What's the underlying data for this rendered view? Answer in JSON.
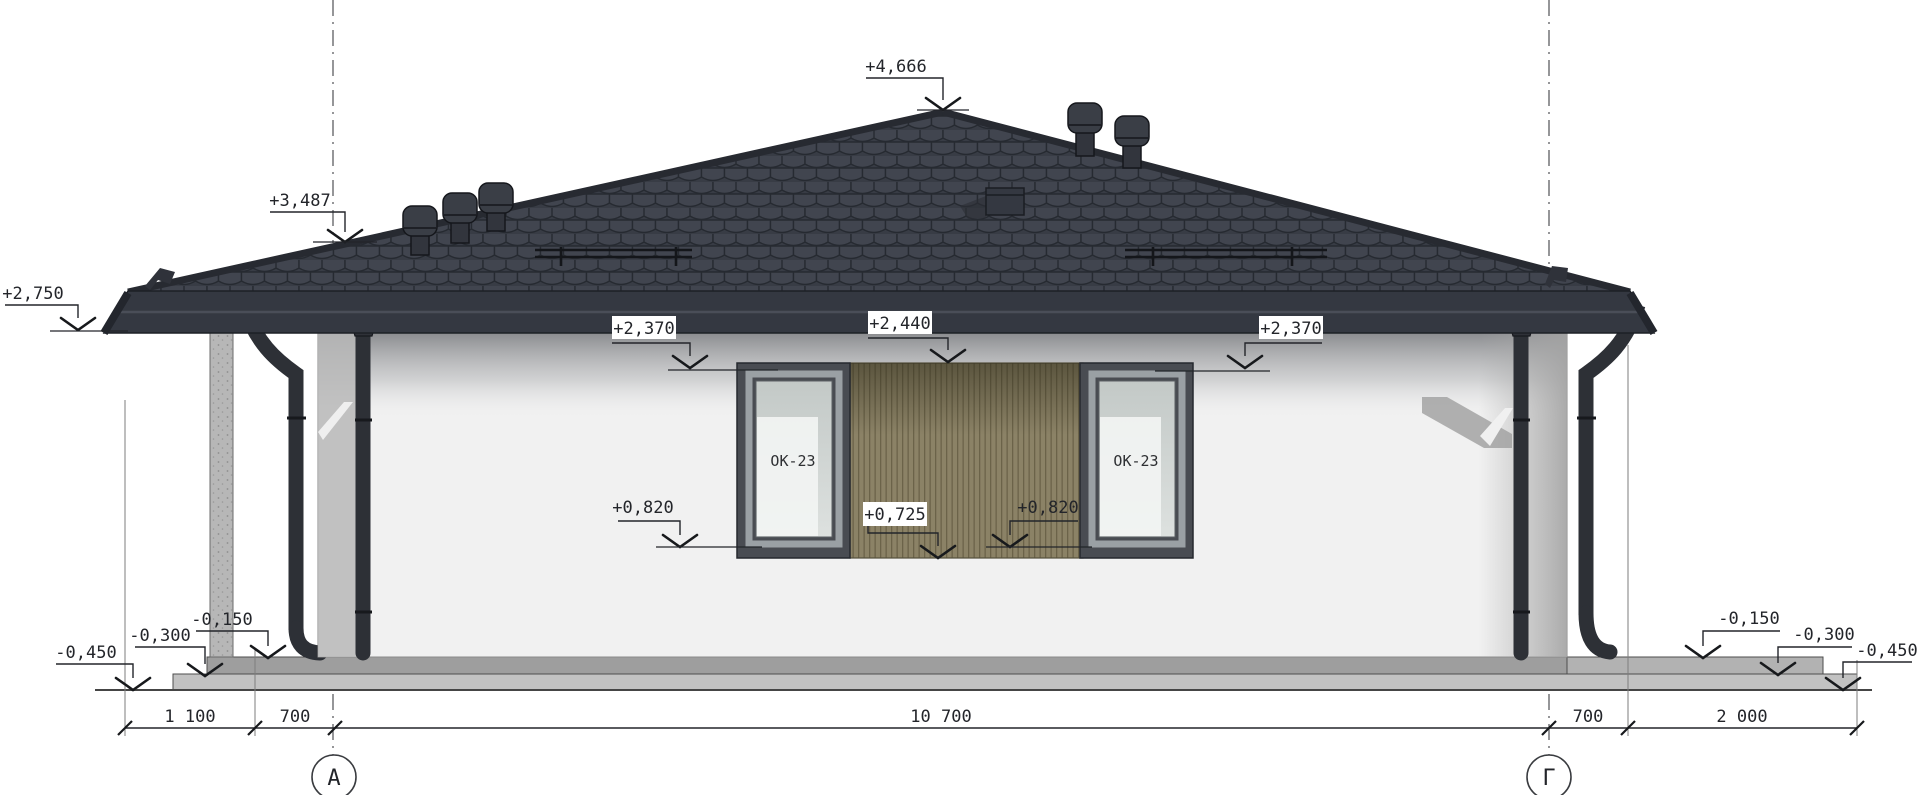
{
  "marks": [
    {
      "id": "roof-peak",
      "value": "+4,666"
    },
    {
      "id": "roof-at-axis-a",
      "value": "+3,487"
    },
    {
      "id": "eave-left",
      "value": "+2,750"
    },
    {
      "id": "left-window-head",
      "value": "+2,370"
    },
    {
      "id": "cladding-top",
      "value": "+2,440"
    },
    {
      "id": "right-window-head",
      "value": "+2,370"
    },
    {
      "id": "left-window-sill",
      "value": "+0,820"
    },
    {
      "id": "cladding-bottom",
      "value": "+0,725"
    },
    {
      "id": "right-window-sill",
      "value": "+0,820"
    },
    {
      "id": "left-terrace-upper",
      "value": "-0,150"
    },
    {
      "id": "left-terrace-lower",
      "value": "-0,300"
    },
    {
      "id": "left-ground",
      "value": "-0,450"
    },
    {
      "id": "right-terrace-upper",
      "value": "-0,150"
    },
    {
      "id": "right-terrace-lower",
      "value": "-0,300"
    },
    {
      "id": "right-ground",
      "value": "-0,450"
    }
  ],
  "windows": [
    {
      "label": "ОК-23"
    },
    {
      "label": "ОК-23"
    }
  ],
  "dimensions": [
    {
      "label": "1 100"
    },
    {
      "label": "700"
    },
    {
      "label": "10 700"
    },
    {
      "label": "700"
    },
    {
      "label": "2 000"
    }
  ],
  "axes": [
    {
      "label": "А"
    },
    {
      "label": "Г"
    }
  ],
  "colors": {
    "roof_tile": "#3e424c",
    "roof_line": "#262a31",
    "fascia": "#343841",
    "wall": "#f1f1f1",
    "wood_cladding": "#8b8266",
    "window_frame": "#494c52",
    "pipe": "#2d3036",
    "slab_upper": "#9e9e9e",
    "slab_lower": "#c2c2c2",
    "dim_ink": "#23252a"
  }
}
